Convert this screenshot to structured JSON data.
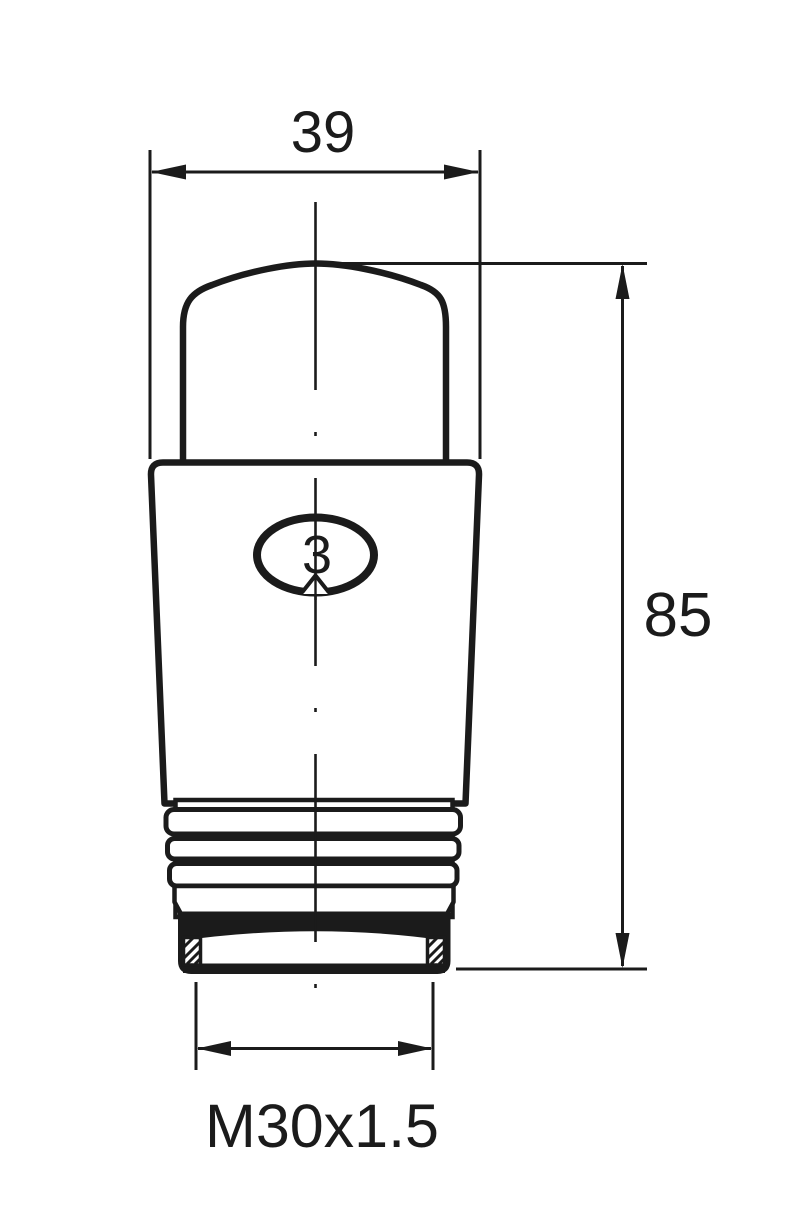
{
  "page": {
    "background_color": "#ffffff",
    "ink_color": "#1b1b1b"
  },
  "drawing": {
    "type": "technical-drawing",
    "subject": "thermostatic-radiator-valve-head-front-view",
    "dimensions": {
      "head_width": {
        "label": "39"
      },
      "overall_height": {
        "label": "85"
      },
      "thread": {
        "label": "M30x1.5"
      }
    },
    "indicator": {
      "setting": "3"
    }
  }
}
